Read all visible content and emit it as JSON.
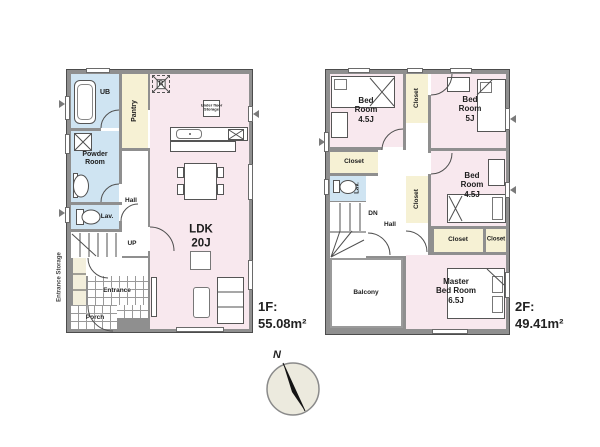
{
  "floor1": {
    "area_label": "1F:",
    "area_value": "55.08m²",
    "rooms": {
      "ub": "UB",
      "pantry": "Pantry",
      "powder": "Powder\nRoom",
      "lav": "Lav.",
      "hall": "Hall",
      "up": "UP",
      "entrance": "Entrance",
      "porch": "Porch",
      "entrance_storage": "Entrance Storage",
      "ldk": "LDK\n20J",
      "fridge": "R",
      "underfloor": "Under floor\nStorage"
    }
  },
  "floor2": {
    "area_label": "2F:",
    "area_value": "49.41m²",
    "rooms": {
      "bed1": "Bed\nRoom\n4.5J",
      "bed2": "Bed\nRoom\n5J",
      "bed3": "Bed\nRoom\n4.5J",
      "master": "Master\nBed Room\n6.5J",
      "closet": "Closet",
      "lav": "Lav.",
      "dn": "DN",
      "hall": "Hall",
      "balcony": "Balcony"
    }
  },
  "compass": {
    "north": "N"
  },
  "colors": {
    "room_pink": "#f8e8ee",
    "wet_blue": "#cfe4f2",
    "closet_yellow": "#f6f1d4",
    "wall_gray": "#8f8f8f",
    "wall_edge": "#4c4c4c"
  }
}
